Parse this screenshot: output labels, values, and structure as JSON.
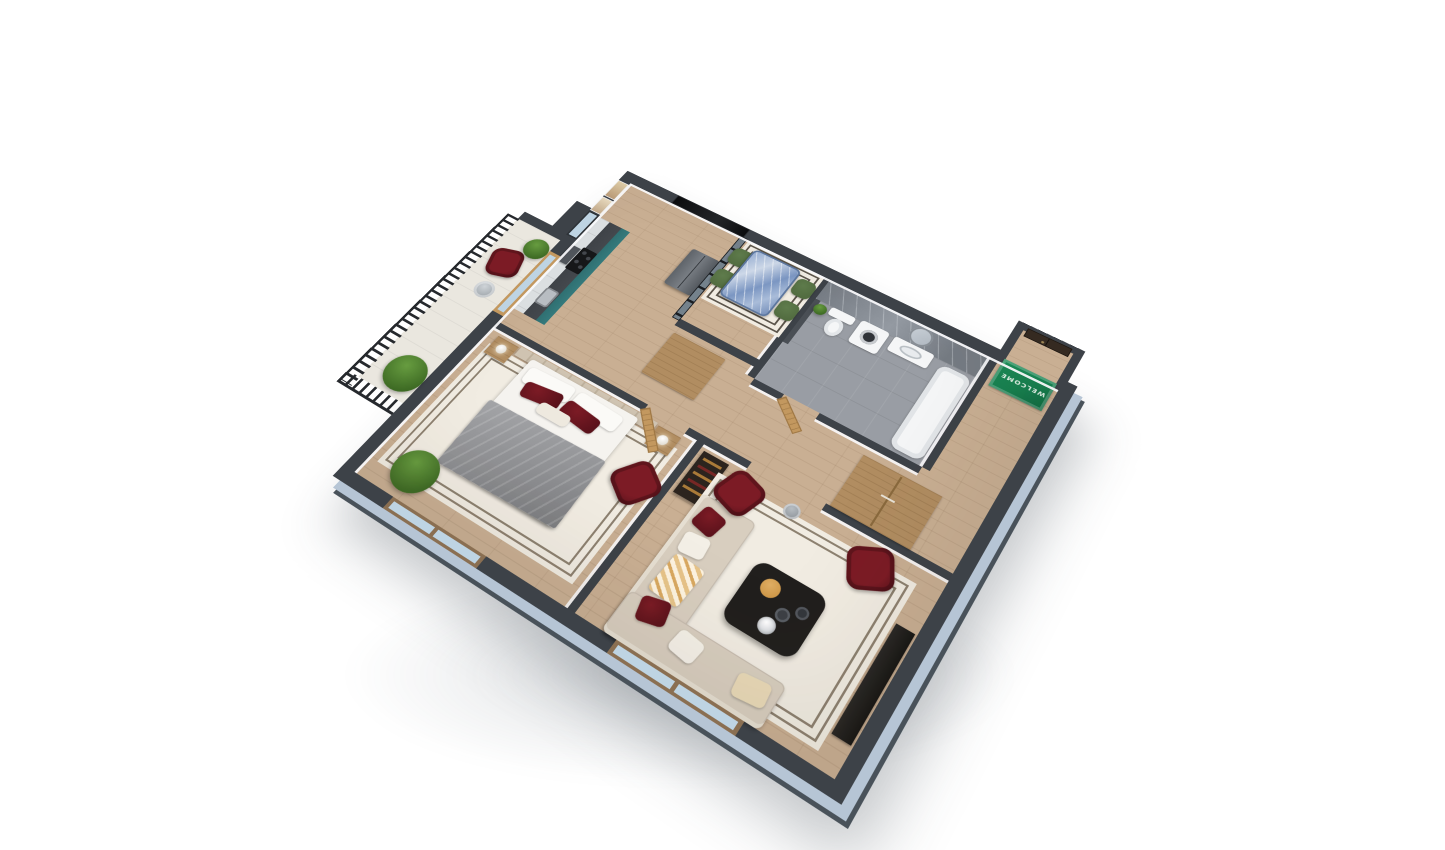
{
  "scene": {
    "type": "3d-isometric-floor-plan-render",
    "background": "#ffffff",
    "view": "top-down tilted axonometric, one-bedroom apartment with balcony"
  },
  "entry": {
    "welcome_mat_text": "WELCOME"
  },
  "rooms": [
    {
      "id": "kitchen-dining",
      "furniture": [
        "teal-kitchen-counter",
        "dark-countertop",
        "stove",
        "range-hood",
        "sink",
        "upper-cabinets",
        "steel-fridge",
        "glass-partition",
        "blue-marble-dining-table",
        "green-dining-chairs-x4",
        "wall-tv",
        "framed-artwork-x2",
        "shoe-cabinet",
        "patterned-rug"
      ]
    },
    {
      "id": "bathroom",
      "furniture": [
        "gray-marble-wall",
        "toilet",
        "washing-machine",
        "vanity-sink",
        "round-mirror",
        "bathtub",
        "small-plant",
        "wood-door"
      ]
    },
    {
      "id": "entry-hall",
      "furniture": [
        "dark-front-door",
        "green-welcome-mat",
        "wood-wardrobe",
        "display-cabinet"
      ]
    },
    {
      "id": "bedroom",
      "furniture": [
        "double-bed",
        "gray-throw-blanket",
        "red-pillows",
        "headboard-panel",
        "nightstands-x2",
        "lamps-x2",
        "stepped-border-rug",
        "red-armchair",
        "plant",
        "double-window",
        "wood-door"
      ]
    },
    {
      "id": "living-room",
      "furniture": [
        "beige-corner-sofa",
        "gold-throw",
        "red-pillows",
        "dark-coffee-table",
        "gold-tray",
        "red-armchairs-x2",
        "side-table",
        "media-console",
        "stepped-border-rug",
        "window"
      ]
    },
    {
      "id": "balcony",
      "furniture": [
        "black-railing",
        "red-armchair",
        "round-side-table",
        "plants-x2",
        "glazed-door"
      ]
    }
  ],
  "colors": {
    "wall-top": "#3d4248",
    "ext-face": "#b6c5d5",
    "ext-base": "#49525a",
    "floor-wood": "#c9af93",
    "bath-floor": "#999da4",
    "bath-marble": "#757b83",
    "bath-marble-light": "#959ba3",
    "kitchen-teal": "#2c686a",
    "counter-top": "#45494e",
    "cabinet-light": "#dde1e3",
    "fridge-steel": "#787d83",
    "accent-red": "#7c1b25",
    "accent-red-dark": "#551019",
    "mat-green": "#168150",
    "mat-green-dark": "#0e6b40",
    "door-wood": "#c3985f",
    "door-wood-dark": "#9b7441",
    "front-door": "#352a21",
    "rug-cream": "#f1ece2",
    "rug-line": "#8d8170",
    "sofa-beige": "#d8cebf",
    "sofa-light": "#e6dfd2",
    "marble-blue": "#7b96c2",
    "marble-light": "#cdd8e8",
    "chair-green": "#526c40",
    "plant-green": "#679c40",
    "plant-dark": "#3e6b24",
    "railing": "#26292d",
    "glass": "#bed4e3",
    "table-dark": "#211f1d",
    "gold": "#c8903f",
    "blanket-gray": "#909194",
    "wood-furn": "#b18d61",
    "white-fix": "#f5f6f7",
    "headboard": "#cfc3b1"
  }
}
